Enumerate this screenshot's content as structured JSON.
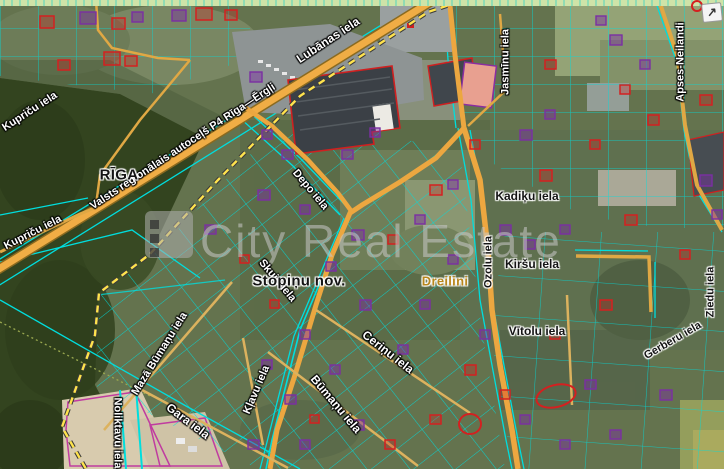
{
  "watermark": {
    "brand": "City Real Estate"
  },
  "controls": {
    "expand_arrow": "↗"
  },
  "labels": {
    "places": [
      {
        "name": "RĪGA"
      },
      {
        "name": "Stopiņu nov."
      },
      {
        "name": "Dreilini"
      }
    ],
    "streets": [
      "Kupriču iela",
      "Kupriču iela",
      "Valsts reģionālais autoceļš P4 Rīga—Ērgļi",
      "Lubānas iela",
      "Jasmīnu iela",
      "Apses-Neilandi",
      "Depo iela",
      "Skuju iela",
      "Kadiķu iela",
      "Kiršu iela",
      "Ozolu iela",
      "Vītolu iela",
      "Gerberu iela",
      "Ziedu iela",
      "Ceriņu iela",
      "Būmaņu iela",
      "Kļavu iela",
      "Mazā Būmaņu iela",
      "Gara iela",
      "Noliktavu iela"
    ]
  },
  "colors": {
    "parcel_line": "#00dede",
    "road_fill": "#f0ad45",
    "boundary_dash": "#ffe34d",
    "building_red": "#d42020",
    "building_purple": "#7b2fa3",
    "forest": "#33441f",
    "field_strip": "#cfe3a8",
    "place_gold": "#b8861c"
  }
}
